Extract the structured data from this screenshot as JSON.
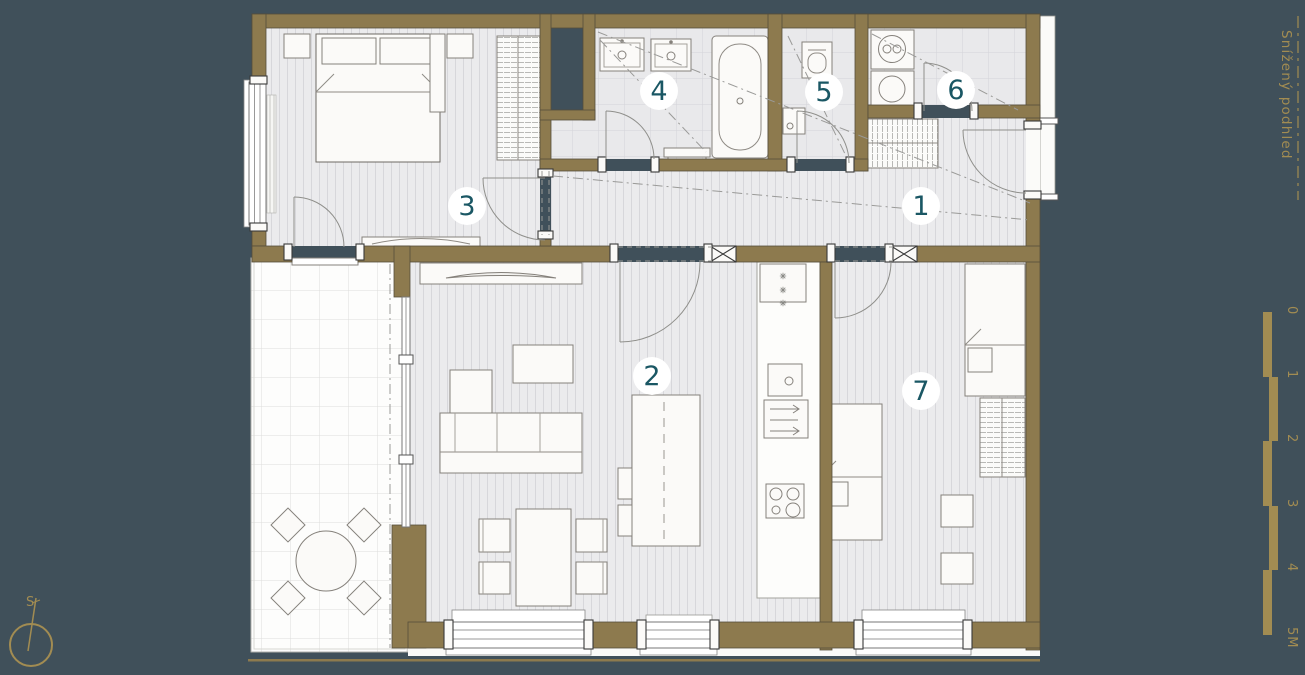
{
  "plan": {
    "rooms": [
      {
        "label": "1"
      },
      {
        "label": "2"
      },
      {
        "label": "3"
      },
      {
        "label": "4"
      },
      {
        "label": "5"
      },
      {
        "label": "6"
      },
      {
        "label": "7"
      }
    ],
    "side_note": "Snížený podhled",
    "compass_label": "S",
    "scale_bar": {
      "labels": [
        "0",
        "1",
        "2",
        "3",
        "4",
        "5M"
      ]
    },
    "colors": {
      "background": "#40505a",
      "wall": "#8d7a4e",
      "accent_gold": "#a28c52",
      "room_number_teal": "#1a5764",
      "floor_light": "#ebebed"
    }
  }
}
